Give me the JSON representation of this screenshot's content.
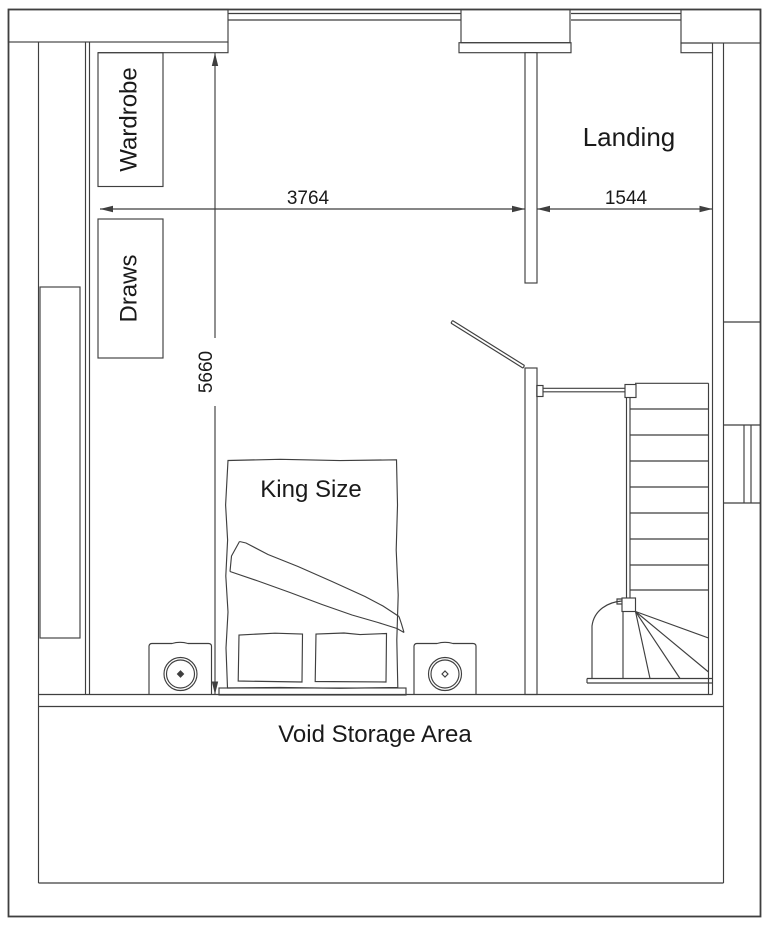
{
  "drawing": {
    "type": "floor-plan",
    "background_color": "#ffffff",
    "line_color": "#3f3f3f",
    "text_color": "#1a1a1a"
  },
  "labels": {
    "wardrobe": "Wardrobe",
    "draws": "Draws",
    "landing": "Landing",
    "king_size": "King Size",
    "void_storage": "Void Storage Area"
  },
  "dimensions": {
    "bedroom_width_mm": "3764",
    "landing_width_mm": "1544",
    "room_depth_mm": "5660"
  }
}
